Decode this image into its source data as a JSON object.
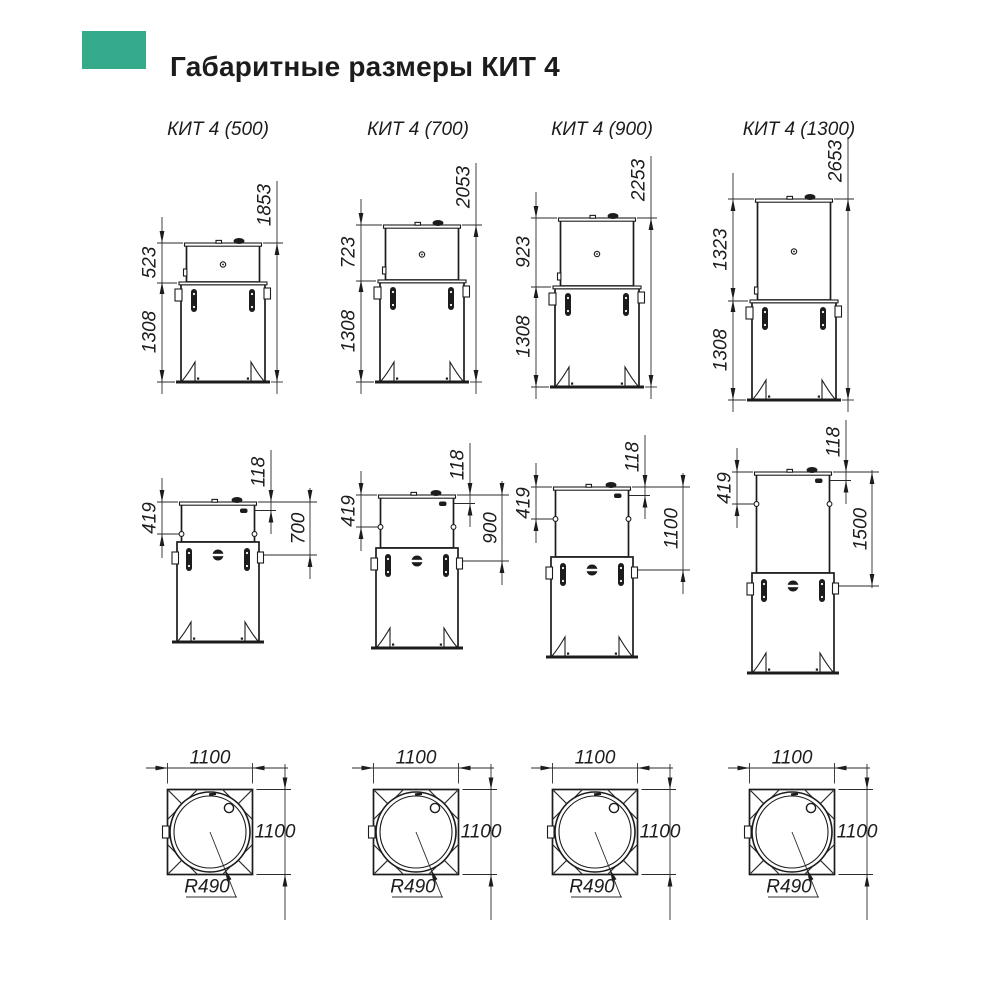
{
  "title": "Габаритные размеры КИТ 4",
  "accent_color": "#36ab8c",
  "columns": [
    {
      "label": "КИТ 4 (500)",
      "front": {
        "upper": "523",
        "lower": "1308",
        "total": "1853"
      },
      "side": {
        "neck": "419",
        "inlet_offset": "118",
        "inlet_depth": "700"
      },
      "top": {
        "width": "1100",
        "depth": "1100",
        "radius": "R490"
      }
    },
    {
      "label": "КИТ 4 (700)",
      "front": {
        "upper": "723",
        "lower": "1308",
        "total": "2053"
      },
      "side": {
        "neck": "419",
        "inlet_offset": "118",
        "inlet_depth": "900"
      },
      "top": {
        "width": "1100",
        "depth": "1100",
        "radius": "R490"
      }
    },
    {
      "label": "КИТ 4 (900)",
      "front": {
        "upper": "923",
        "lower": "1308",
        "total": "2253"
      },
      "side": {
        "neck": "419",
        "inlet_offset": "118",
        "inlet_depth": "1100"
      },
      "top": {
        "width": "1100",
        "depth": "1100",
        "radius": "R490"
      }
    },
    {
      "label": "КИТ 4 (1300)",
      "front": {
        "upper": "1323",
        "lower": "1308",
        "total": "2653"
      },
      "side": {
        "neck": "419",
        "inlet_offset": "118",
        "inlet_depth": "1500"
      },
      "top": {
        "width": "1100",
        "depth": "1100",
        "radius": "R490"
      }
    }
  ]
}
